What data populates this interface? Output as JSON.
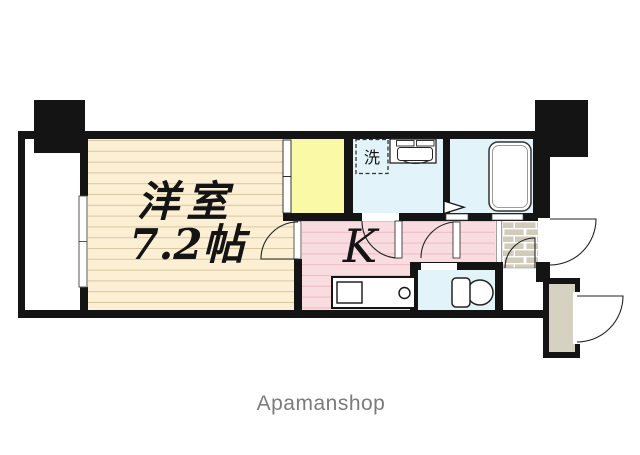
{
  "plan": {
    "room": {
      "name": "洋室",
      "size": "7.2帖"
    },
    "kitchen_label": "K",
    "laundry_label": "洗"
  },
  "watermark": {
    "text": "Apamanshop"
  },
  "colors": {
    "wall": "#141414",
    "wood_floor": "#fcefd4",
    "wood_line": "#d7c8a2",
    "kitchen_floor": "#f9dce0",
    "kitchen_line": "#eebac4",
    "wet_area_blue": "#e2f3f9",
    "closet_yellow": "#faf9a5",
    "entrance_tile": "#d2cbba",
    "storage_beige": "#d6d2c2",
    "watermark_gray": "#7b7b7b"
  }
}
